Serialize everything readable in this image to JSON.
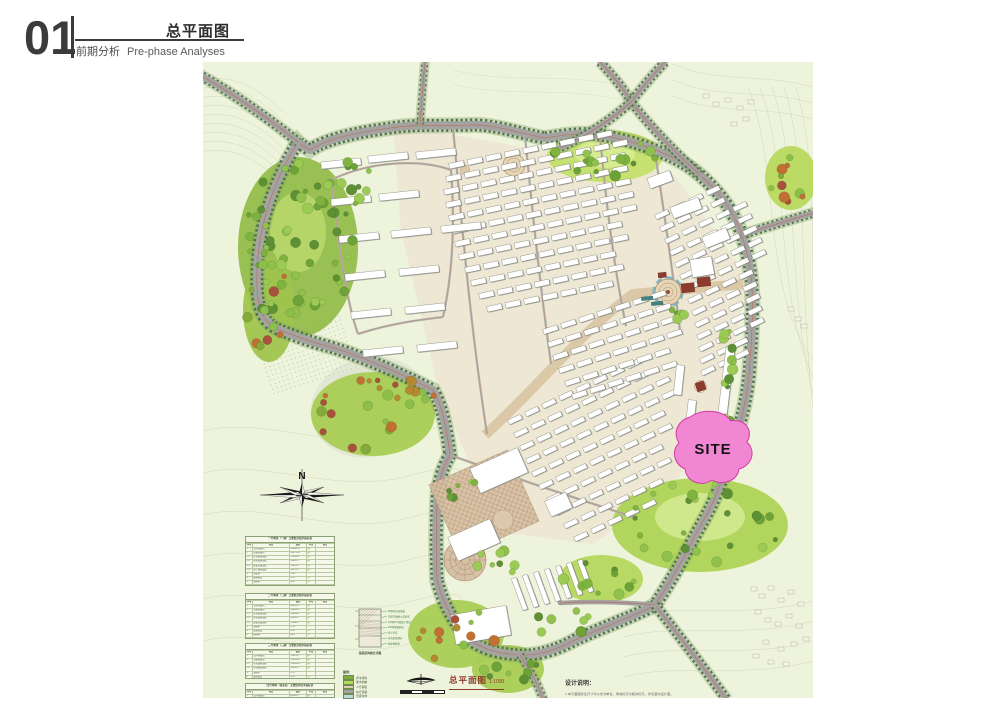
{
  "colors": {
    "map_bg": "#eef3dc",
    "contour": "#ccd4b6",
    "road": "#a3a3a1",
    "road_tree": "#4c6b4e",
    "road_line": "#c2604c",
    "axis": "#d9c6a4",
    "paving": "#ecdccb",
    "park_green": "#aed455",
    "forest_green": "#93bd4a",
    "lake": "#e3e8d4",
    "building_fill": "#ffffff",
    "building_edge": "#63635a",
    "building_shadow": "#8b9089",
    "site_pink": "#f186d3",
    "site_outline": "#cf3da6",
    "label_red": "#8e3b2c",
    "accent_red": "#8d3b2e",
    "accent_teal": "#45807e",
    "water_blue": "#7db5c9"
  },
  "header": {
    "number": "01",
    "title": "总平面图",
    "subtitle_cn": "前期分析",
    "subtitle_en": "Pre-phase Analyses"
  },
  "map": {
    "site_label": "SITE",
    "compass_label": "N",
    "plan_label": "总平面图",
    "plan_scale": "1:1000",
    "notes_title": "设计说明：",
    "notes_line": "1.本平面图标注尺寸均以米为单位，场地标高为相对标高，详见竖向设计图。",
    "legend_title": "图例：",
    "legend_items": [
      {
        "label": "乔木绿化",
        "color": "#7fae3f"
      },
      {
        "label": "灌木地被",
        "color": "#b5d95e"
      },
      {
        "label": "人行铺装",
        "color": "#ddcdb6"
      },
      {
        "label": "车行道路",
        "color": "#a3a3a1"
      },
      {
        "label": "景观水体",
        "color": "#bcd9e2"
      }
    ],
    "section_caption": "铺装结构做法详图",
    "section_callouts": [
      "60厚花岗岩铺装",
      "30厚干硬性水泥砂浆",
      "100厚C15混凝土垫层",
      "150厚级配碎石",
      "素土夯实",
      "花岗岩路缘石",
      "绿化种植带"
    ],
    "tables": [
      {
        "title": "一号地块（一期）主要经济技术指标表",
        "columns": [
          "序号",
          "项目",
          "数值",
          "单位",
          "备注"
        ],
        "rows": [
          [
            "1",
            "总用地面积",
            "106482.5",
            "㎡",
            ""
          ],
          [
            "2",
            "总建筑面积",
            "265731.8",
            "㎡",
            ""
          ],
          [
            "2.1",
            "住宅建筑面积",
            "213506.2",
            "㎡",
            ""
          ],
          [
            "2.2",
            "商业建筑面积",
            "26381.5",
            "㎡",
            ""
          ],
          [
            "2.3",
            "配套公建面积",
            "15624.8",
            "㎡",
            ""
          ],
          [
            "2.4",
            "地下建筑面积",
            "10219.3",
            "㎡",
            ""
          ],
          [
            "3",
            "容积率",
            "2.40",
            "",
            ""
          ],
          [
            "4",
            "建筑密度",
            "21.8",
            "%",
            ""
          ],
          [
            "5",
            "绿地率",
            "35.6",
            "%",
            ""
          ],
          [
            "6",
            "总户数",
            "1856",
            "户",
            ""
          ],
          [
            "7",
            "机动车停车位",
            "1620",
            "辆",
            "地上460 地下1160"
          ],
          [
            "8",
            "非机动车停车位",
            "2280",
            "辆",
            ""
          ]
        ]
      },
      {
        "title": "二号地块（二期）主要经济技术指标表",
        "columns": [
          "序号",
          "项目",
          "数值",
          "单位",
          "备注"
        ],
        "rows": [
          [
            "1",
            "总用地面积",
            "88352.6",
            "㎡",
            ""
          ],
          [
            "2",
            "总建筑面积",
            "198464.3",
            "㎡",
            ""
          ],
          [
            "2.1",
            "住宅建筑面积",
            "156208.7",
            "㎡",
            ""
          ],
          [
            "2.2",
            "商业建筑面积",
            "20145.2",
            "㎡",
            ""
          ],
          [
            "2.3",
            "配套公建面积",
            "12086.1",
            "㎡",
            ""
          ],
          [
            "3",
            "容积率",
            "2.25",
            "",
            ""
          ],
          [
            "4",
            "建筑密度",
            "20.6",
            "%",
            ""
          ],
          [
            "5",
            "绿地率",
            "36.8",
            "%",
            ""
          ],
          [
            "6",
            "总户数",
            "1420",
            "户",
            ""
          ],
          [
            "7",
            "机动车停车位",
            "1280",
            "辆",
            "地上380 地下900"
          ]
        ]
      },
      {
        "title": "三号地块（三期）主要经济技术指标表",
        "columns": [
          "序号",
          "项目",
          "数值",
          "单位",
          "备注"
        ],
        "rows": [
          [
            "1",
            "总用地面积",
            "72415.8",
            "㎡",
            ""
          ],
          [
            "2",
            "总建筑面积",
            "152830.4",
            "㎡",
            ""
          ],
          [
            "2.1",
            "住宅建筑面积",
            "121652.6",
            "㎡",
            ""
          ],
          [
            "2.2",
            "商业建筑面积",
            "16248.3",
            "㎡",
            ""
          ],
          [
            "3",
            "容积率",
            "2.11",
            "",
            ""
          ],
          [
            "4",
            "建筑密度",
            "19.8",
            "%",
            ""
          ],
          [
            "5",
            "绿地率",
            "38.2",
            "%",
            ""
          ],
          [
            "6",
            "机动车停车位",
            "1050",
            "辆",
            ""
          ]
        ]
      },
      {
        "title": "四号地块（商业区）主要经济技术指标表",
        "columns": [
          "序号",
          "项目",
          "数值",
          "单位",
          "备注"
        ],
        "rows": [
          [
            "1",
            "总用地面积",
            "65280.2",
            "㎡",
            ""
          ],
          [
            "2",
            "总建筑面积",
            "124516.7",
            "㎡",
            ""
          ],
          [
            "3",
            "容积率",
            "1.91",
            "",
            ""
          ]
        ]
      }
    ]
  }
}
